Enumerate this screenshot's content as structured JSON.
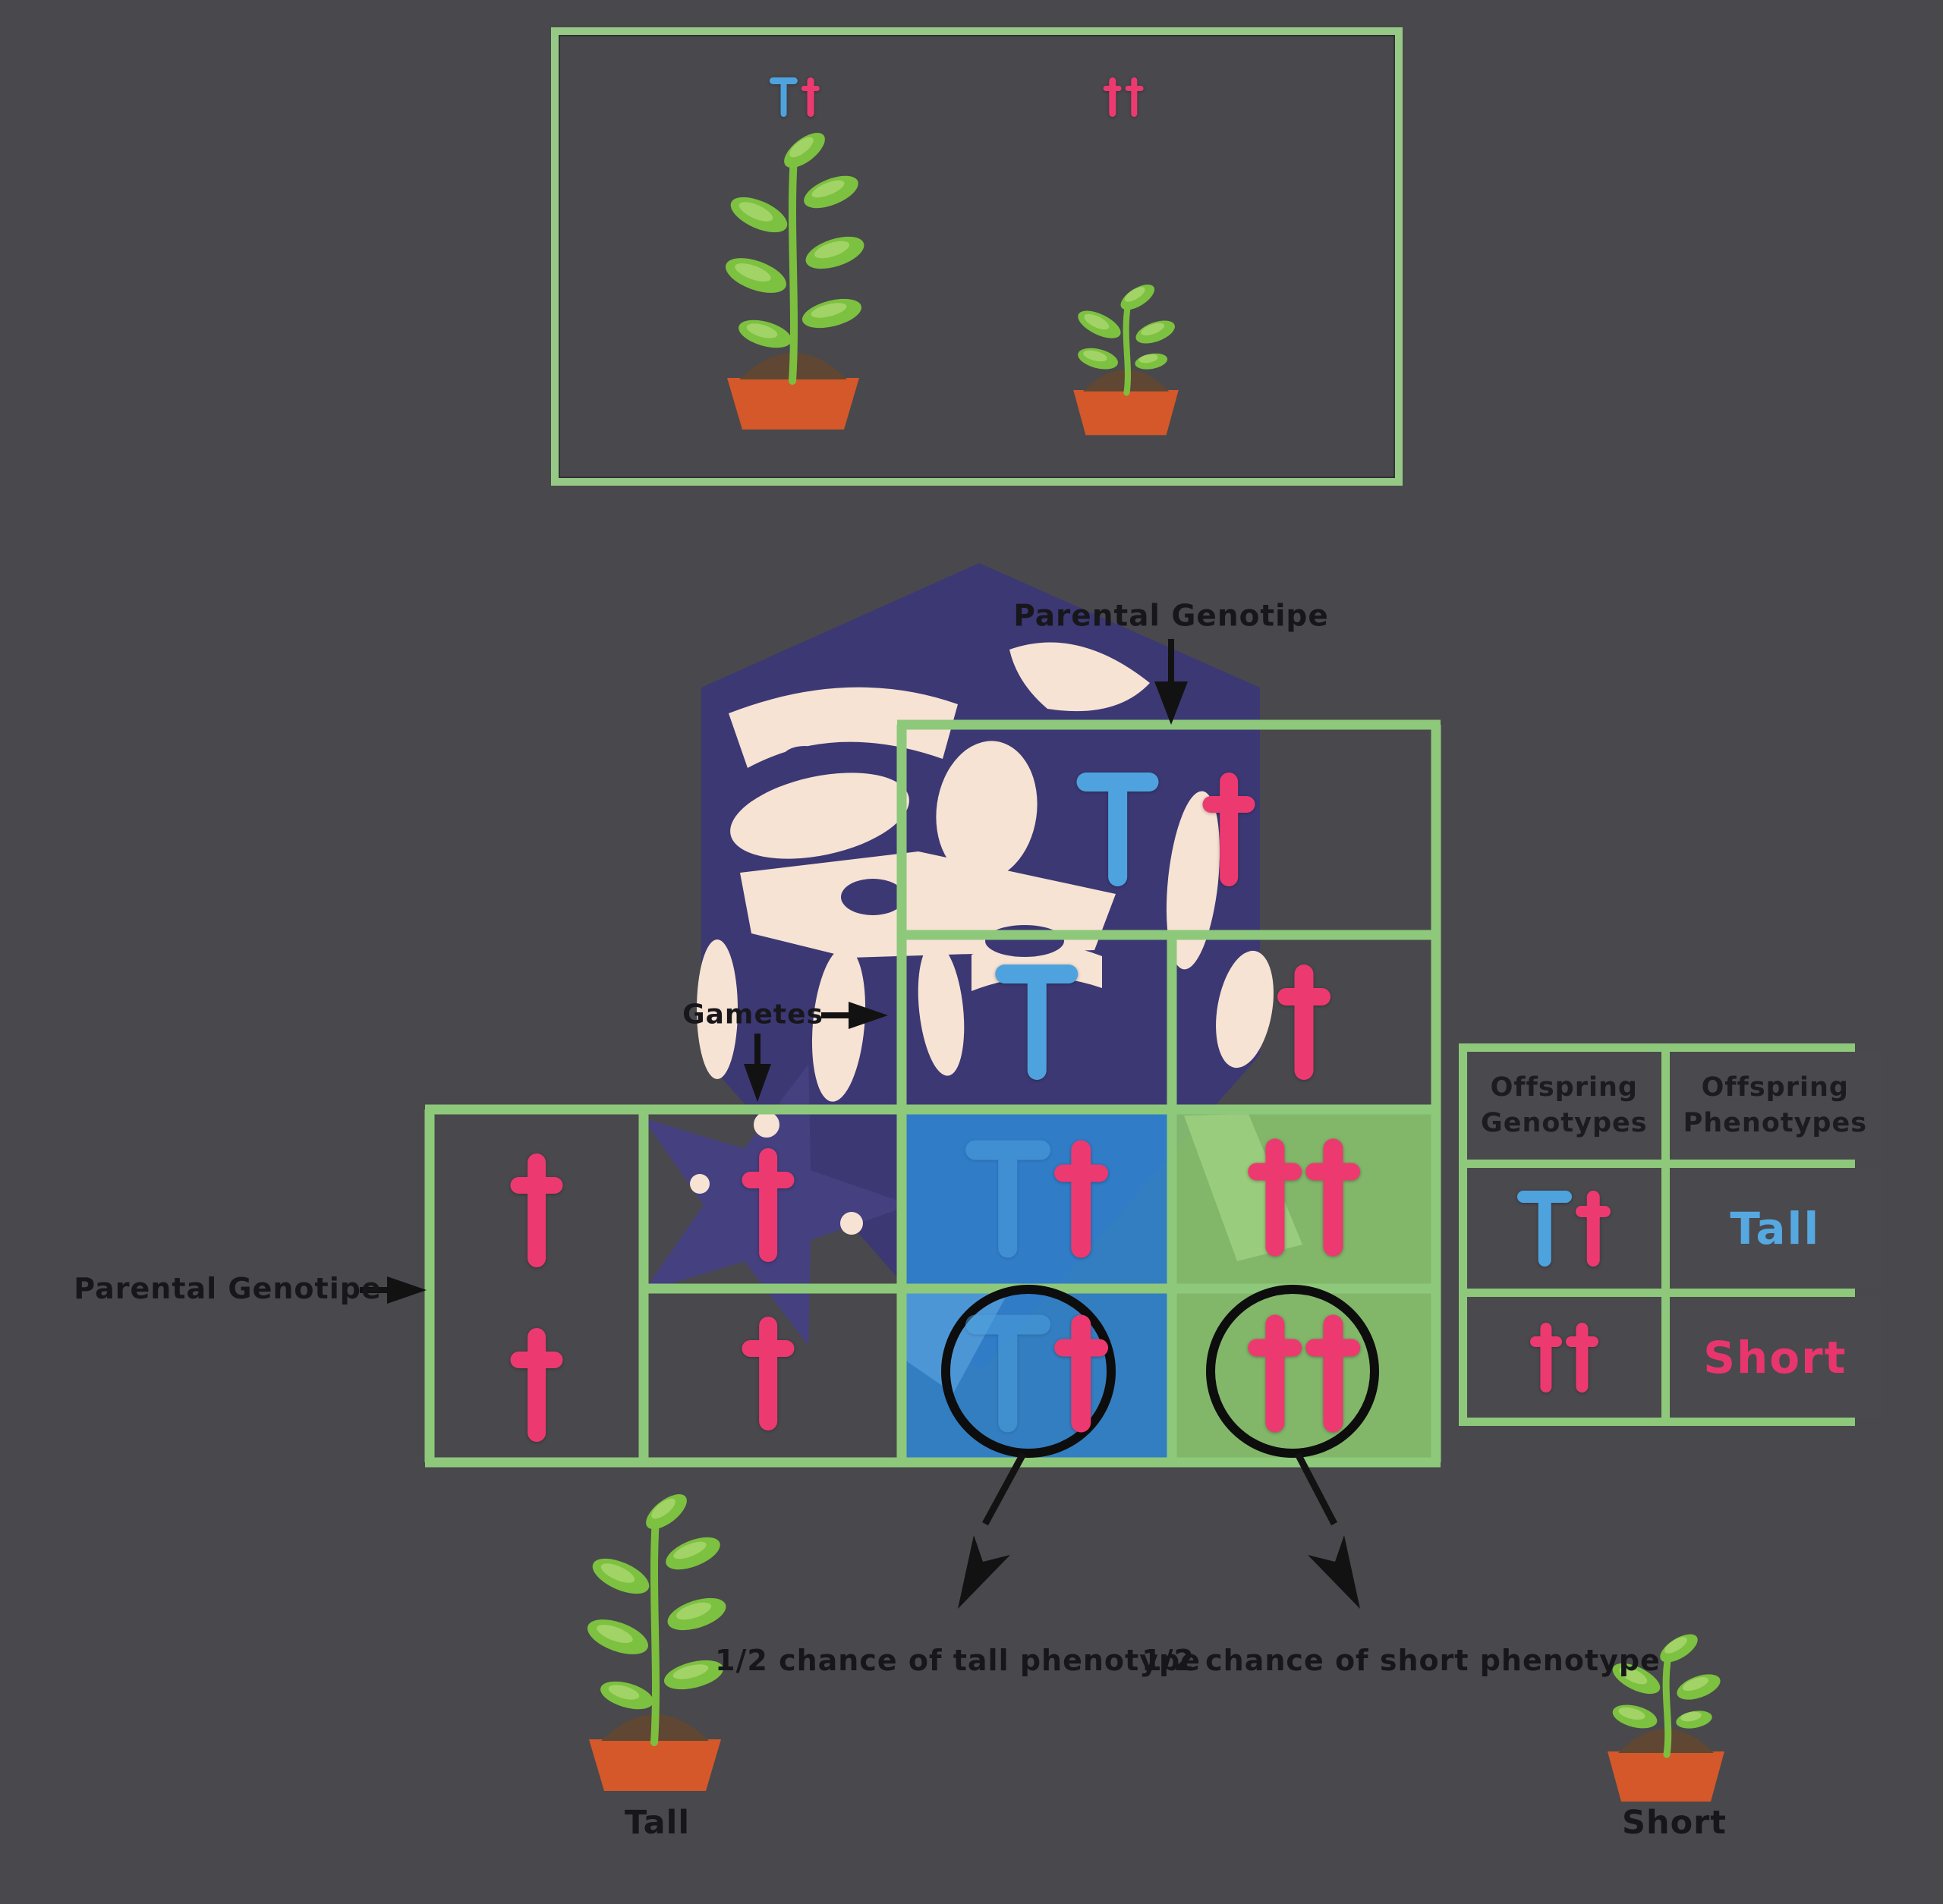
{
  "colors": {
    "background": "#49484c",
    "grid_green": "#8ec87b",
    "box_green": "#96c986",
    "allele_blue": "#4ea3de",
    "allele_pink": "#ec3a70",
    "tall_cell_blue": "#3a8cd6",
    "short_cell_green": "#8bc86e",
    "watermark_navy": "#3c3874",
    "watermark_cream": "#f6e3d3",
    "pot_orange": "#d4582a",
    "soil_brown": "#5f4733",
    "leaf_green": "#7cc140",
    "text_black": "#17171b"
  },
  "top_box": {
    "left_genotype": "Tt",
    "right_genotype": "tt"
  },
  "labels": {
    "parental_genotype_top": "Parental Genotipe",
    "parental_genotype_left": "Parental Genotipe",
    "gametes": "Gametes",
    "tall_chance": "1/2 chance of tall phenotype",
    "short_chance": "1/2 chance of short phenotype",
    "tall": "Tall",
    "short": "Short"
  },
  "punnett": {
    "top_parent": "Tt",
    "top_gametes": [
      "T",
      "t"
    ],
    "left_parent": "tt",
    "left_gametes": [
      "t",
      "t"
    ],
    "offspring": [
      {
        "genotype": "Tt",
        "phenotype": "tall",
        "circled": false
      },
      {
        "genotype": "tt",
        "phenotype": "short",
        "circled": false
      },
      {
        "genotype": "Tt",
        "phenotype": "tall",
        "circled": true
      },
      {
        "genotype": "tt",
        "phenotype": "short",
        "circled": true
      }
    ]
  },
  "offspring_table": {
    "headers": [
      "Offspring Genotypes",
      "Offspring Phenotypes"
    ],
    "rows": [
      {
        "genotype": "Tt",
        "phenotype": "Tall"
      },
      {
        "genotype": "tt",
        "phenotype": "Short"
      }
    ]
  }
}
